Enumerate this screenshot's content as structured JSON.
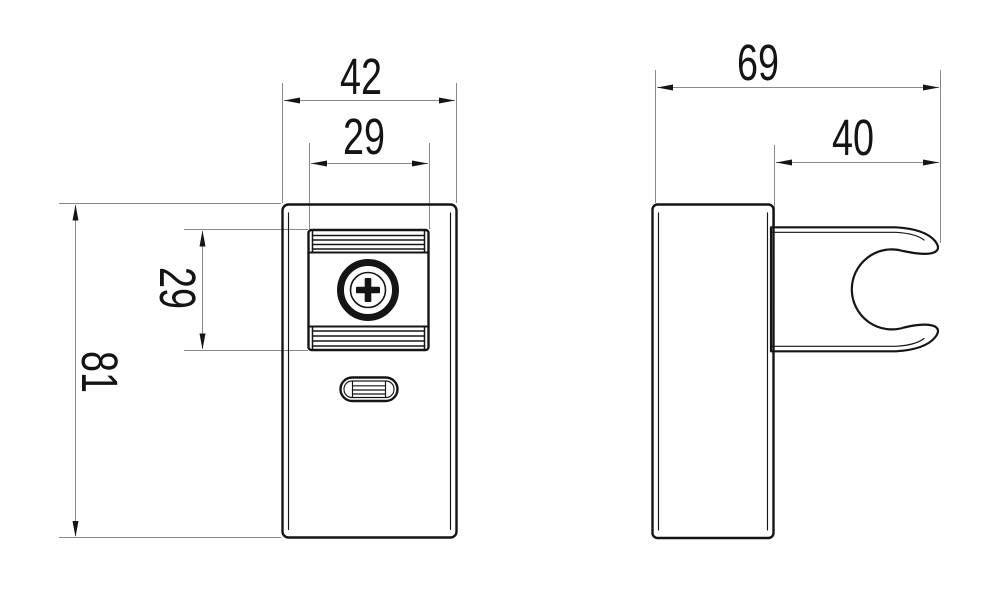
{
  "drawing": {
    "dimensions": {
      "front_width": "42",
      "front_plate_width": "29",
      "front_height": "81",
      "front_plate_height": "29",
      "side_depth": "69",
      "side_clip_depth": "40"
    },
    "colors": {
      "object_line": "#151515",
      "dimension_line": "#8a8a8a",
      "background": "#ffffff"
    }
  }
}
